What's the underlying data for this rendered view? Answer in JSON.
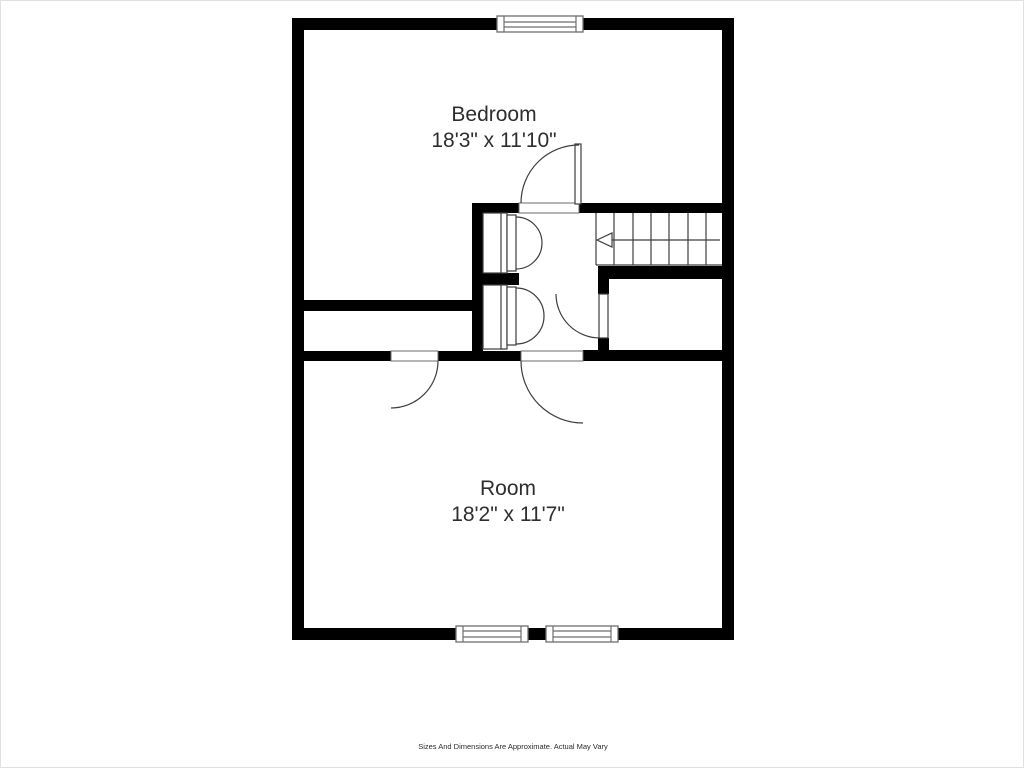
{
  "colors": {
    "wall": "#000000",
    "line": "#3d3d3d",
    "text": "#2e2e2e",
    "background": "#ffffff"
  },
  "rooms": [
    {
      "label": "Bedroom",
      "dimensions": "18'3\" x 11'10\""
    },
    {
      "label": "Room",
      "dimensions": "18'2\" x 11'7\""
    }
  ],
  "stairs": {
    "direction_arrow": "left"
  },
  "disclaimer": "Sizes And Dimensions Are Approximate. Actual May Vary"
}
